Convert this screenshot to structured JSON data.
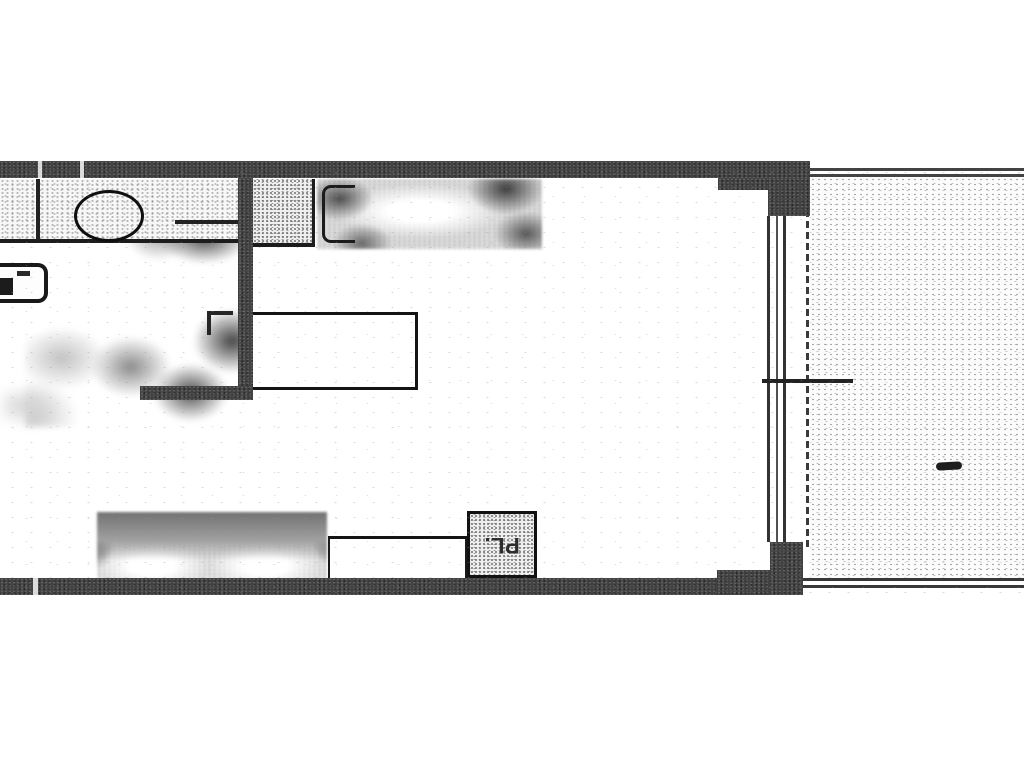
{
  "document": {
    "kind": "scanned-apartment-floor-plan",
    "closet_label": "PL."
  },
  "floorplan": {
    "colors": {
      "paper": "#ffffff",
      "wall": "#424242",
      "ink_line": "#1a1a1a",
      "stipple_dot": "#8a8a8a",
      "blob_dark": "#4c4c4c",
      "blob_light": "#cdcdcd"
    },
    "features": [
      "top-exterior-wall",
      "bottom-exterior-wall",
      "kitchen-partition-wall",
      "kitchen-counter",
      "kitchen-sink-oval",
      "kitchen-appliance",
      "bed-with-headboard",
      "center-table",
      "sofa-with-cushions",
      "side-table",
      "closet-pl",
      "sliding-glass-door",
      "door-handle-line",
      "balcony-terrace",
      "balcony-railing-lines",
      "balcony-small-mark"
    ]
  }
}
